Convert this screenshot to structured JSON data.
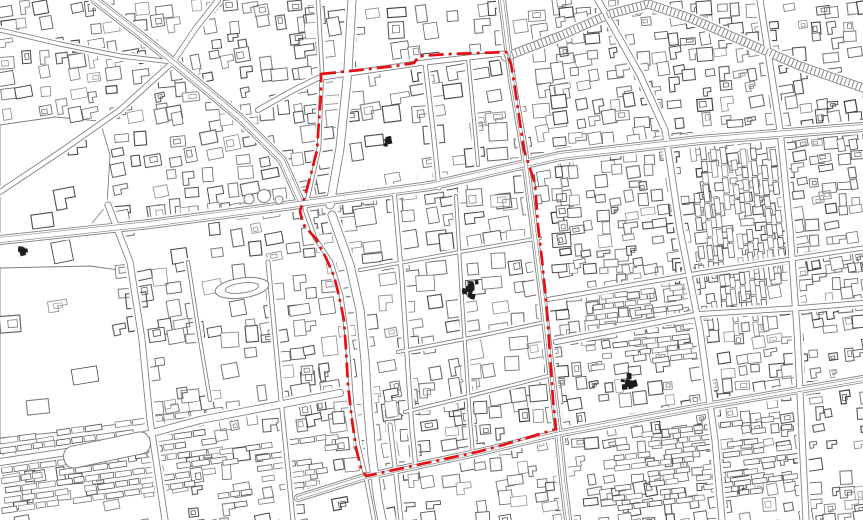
{
  "meta": {
    "canvas": {
      "width": 863,
      "height": 520
    },
    "seed": 1337,
    "colors": {
      "background": "#ffffff",
      "map_line": "#7d7d7d",
      "building_gray_min": 58,
      "building_gray_max": 150,
      "boundary_red": "#e60e13",
      "blob_dark": "#1d1d1d"
    }
  },
  "boundary": {
    "description": "red dash-dot district boundary",
    "stroke_width": 2.7,
    "dash": [
      15,
      5,
      3,
      5
    ],
    "closed": true,
    "points": [
      [
        321,
        74
      ],
      [
        360,
        70
      ],
      [
        395,
        66
      ],
      [
        414,
        63
      ],
      [
        419,
        56
      ],
      [
        450,
        54
      ],
      [
        480,
        53
      ],
      [
        506,
        52
      ],
      [
        511,
        64
      ],
      [
        514,
        82
      ],
      [
        524,
        150
      ],
      [
        535,
        184
      ],
      [
        538,
        226
      ],
      [
        542,
        260
      ],
      [
        546,
        300
      ],
      [
        549,
        340
      ],
      [
        553,
        400
      ],
      [
        556,
        429
      ],
      [
        533,
        436
      ],
      [
        503,
        445
      ],
      [
        477,
        452
      ],
      [
        440,
        460
      ],
      [
        403,
        468
      ],
      [
        366,
        476
      ],
      [
        361,
        468
      ],
      [
        356,
        448
      ],
      [
        352,
        420
      ],
      [
        348,
        385
      ],
      [
        346,
        350
      ],
      [
        344,
        320
      ],
      [
        339,
        296
      ],
      [
        334,
        276
      ],
      [
        326,
        258
      ],
      [
        316,
        239
      ],
      [
        303,
        224
      ],
      [
        300,
        211
      ],
      [
        305,
        196
      ],
      [
        312,
        170
      ],
      [
        317,
        150
      ],
      [
        319,
        120
      ],
      [
        321,
        95
      ]
    ]
  },
  "creek": {
    "width": 4.5,
    "points": [
      [
        318,
        0
      ],
      [
        322,
        70
      ],
      [
        319,
        148
      ],
      [
        305,
        210
      ],
      [
        315,
        238
      ],
      [
        331,
        262
      ],
      [
        341,
        295
      ],
      [
        346,
        330
      ],
      [
        349,
        365
      ],
      [
        352,
        405
      ],
      [
        358,
        445
      ],
      [
        366,
        478
      ],
      [
        374,
        520
      ]
    ]
  },
  "roads": [
    {
      "name": "nw-diagonal-avenue",
      "w": 9,
      "lanes": true,
      "pts": [
        [
          95,
          0
        ],
        [
          140,
          35
        ],
        [
          173,
          62
        ],
        [
          240,
          118
        ],
        [
          282,
          160
        ],
        [
          302,
          205
        ]
      ]
    },
    {
      "name": "ne-sw-cross-street",
      "w": 6,
      "pts": [
        [
          218,
          0
        ],
        [
          196,
          28
        ],
        [
          173,
          62
        ],
        [
          120,
          110
        ],
        [
          60,
          152
        ],
        [
          0,
          192
        ]
      ]
    },
    {
      "name": "west-feeder-street",
      "w": 5,
      "pts": [
        [
          0,
          30
        ],
        [
          60,
          44
        ],
        [
          120,
          56
        ],
        [
          173,
          62
        ]
      ]
    },
    {
      "name": "main-horizontal-boulevard",
      "w": 10,
      "lanes": true,
      "pts": [
        [
          0,
          240
        ],
        [
          150,
          224
        ],
        [
          270,
          208
        ],
        [
          430,
          186
        ],
        [
          560,
          156
        ],
        [
          700,
          140
        ],
        [
          863,
          127
        ]
      ]
    },
    {
      "name": "top-boundary-street",
      "w": 6,
      "pts": [
        [
          258,
          110
        ],
        [
          290,
          92
        ],
        [
          318,
          78
        ],
        [
          420,
          63
        ],
        [
          508,
          53
        ]
      ]
    },
    {
      "name": "elevated-viaduct",
      "w": 9,
      "hatch": true,
      "hatchStep": 4,
      "pts": [
        [
          505,
          57
        ],
        [
          560,
          36
        ],
        [
          610,
          14
        ],
        [
          648,
          4
        ],
        [
          690,
          18
        ],
        [
          745,
          42
        ],
        [
          800,
          66
        ],
        [
          863,
          88
        ]
      ]
    },
    {
      "name": "right-boundary-road",
      "w": 8,
      "lanes": true,
      "pts": [
        [
          502,
          0
        ],
        [
          512,
          80
        ],
        [
          524,
          150
        ],
        [
          543,
          300
        ],
        [
          552,
          380
        ],
        [
          558,
          430
        ],
        [
          563,
          480
        ],
        [
          568,
          520
        ]
      ]
    },
    {
      "name": "east-vertical-street-1",
      "w": 7,
      "pts": [
        [
          598,
          0
        ],
        [
          640,
          75
        ],
        [
          665,
          130
        ],
        [
          680,
          230
        ],
        [
          700,
          330
        ],
        [
          715,
          440
        ],
        [
          722,
          520
        ]
      ]
    },
    {
      "name": "east-vertical-street-2",
      "w": 7,
      "pts": [
        [
          760,
          0
        ],
        [
          780,
          130
        ],
        [
          790,
          230
        ],
        [
          797,
          330
        ],
        [
          806,
          520
        ]
      ]
    },
    {
      "name": "east-cross-street-upper",
      "w": 5,
      "pts": [
        [
          545,
          300
        ],
        [
          700,
          273
        ],
        [
          863,
          248
        ]
      ]
    },
    {
      "name": "east-cross-street-lower",
      "w": 6,
      "pts": [
        [
          556,
          342
        ],
        [
          700,
          314
        ],
        [
          800,
          308
        ],
        [
          863,
          303
        ]
      ]
    },
    {
      "name": "bottom-boundary-road",
      "w": 8,
      "lanes": true,
      "pts": [
        [
          298,
          498
        ],
        [
          365,
          477
        ],
        [
          480,
          452
        ],
        [
          556,
          434
        ],
        [
          700,
          407
        ],
        [
          863,
          379
        ]
      ]
    },
    {
      "name": "southwest-road",
      "w": 8,
      "pts": [
        [
          0,
          462
        ],
        [
          100,
          447
        ],
        [
          200,
          420
        ],
        [
          340,
          393
        ]
      ]
    },
    {
      "name": "west-vertical-street",
      "w": 7,
      "pts": [
        [
          108,
          205
        ],
        [
          130,
          262
        ],
        [
          142,
          340
        ],
        [
          150,
          420
        ],
        [
          165,
          520
        ]
      ]
    },
    {
      "name": "creek-bank-road-north",
      "w": 9,
      "pts": [
        [
          352,
          0
        ],
        [
          348,
          70
        ],
        [
          340,
          148
        ],
        [
          330,
          205
        ]
      ]
    },
    {
      "name": "creek-bank-road-south",
      "w": 9,
      "pts": [
        [
          332,
          215
        ],
        [
          350,
          265
        ],
        [
          360,
          310
        ],
        [
          365,
          360
        ],
        [
          368,
          410
        ],
        [
          372,
          455
        ],
        [
          378,
          500
        ],
        [
          382,
          520
        ]
      ]
    },
    {
      "name": "inner-lane-a",
      "w": 5,
      "pts": [
        [
          425,
          63
        ],
        [
          433,
          130
        ],
        [
          439,
          188
        ]
      ]
    },
    {
      "name": "inner-lane-b",
      "w": 4,
      "pts": [
        [
          468,
          58
        ],
        [
          474,
          120
        ],
        [
          478,
          165
        ]
      ]
    },
    {
      "name": "inner-vertical-1",
      "w": 5,
      "pts": [
        [
          394,
          190
        ],
        [
          402,
          280
        ],
        [
          412,
          430
        ],
        [
          416,
          468
        ]
      ]
    },
    {
      "name": "inner-vertical-2",
      "w": 4,
      "pts": [
        [
          456,
          196
        ],
        [
          462,
          300
        ],
        [
          470,
          420
        ],
        [
          473,
          455
        ]
      ]
    },
    {
      "name": "inner-horizontal-1",
      "w": 4,
      "pts": [
        [
          360,
          270
        ],
        [
          460,
          252
        ],
        [
          540,
          238
        ]
      ]
    },
    {
      "name": "inner-horizontal-2",
      "w": 4,
      "pts": [
        [
          398,
          352
        ],
        [
          470,
          338
        ],
        [
          545,
          322
        ]
      ]
    },
    {
      "name": "inner-horizontal-3",
      "w": 4,
      "pts": [
        [
          405,
          412
        ],
        [
          470,
          396
        ],
        [
          548,
          376
        ]
      ]
    },
    {
      "name": "south-short-street",
      "w": 5,
      "pts": [
        [
          390,
          425
        ],
        [
          396,
          475
        ],
        [
          401,
          520
        ]
      ]
    },
    {
      "name": "left-bottom-vertical",
      "w": 5,
      "pts": [
        [
          268,
          262
        ],
        [
          280,
          390
        ],
        [
          293,
          520
        ]
      ]
    },
    {
      "name": "left-mid-vertical",
      "w": 4,
      "pts": [
        [
          188,
          262
        ],
        [
          200,
          340
        ],
        [
          210,
          400
        ]
      ]
    }
  ],
  "districts": [
    {
      "x": 0,
      "y": 0,
      "w": 310,
      "h": 118,
      "cell": 17,
      "density": 0.72,
      "angle": -8
    },
    {
      "x": 112,
      "y": 112,
      "w": 200,
      "h": 100,
      "cell": 18,
      "density": 0.7,
      "angle": -8
    },
    {
      "x": 112,
      "y": 205,
      "w": 200,
      "h": 132,
      "cell": 19,
      "density": 0.62,
      "angle": -8
    },
    {
      "x": 150,
      "y": 330,
      "w": 165,
      "h": 75,
      "cell": 18,
      "density": 0.6,
      "angle": -8
    },
    {
      "x": 300,
      "y": 0,
      "w": 265,
      "h": 195,
      "cell": 21,
      "density": 0.78,
      "angle": -7
    },
    {
      "x": 295,
      "y": 190,
      "w": 265,
      "h": 225,
      "cell": 21,
      "density": 0.72,
      "angle": -7
    },
    {
      "x": 555,
      "y": 0,
      "w": 308,
      "h": 140,
      "cell": 16,
      "density": 0.82,
      "angle": -7
    },
    {
      "x": 555,
      "y": 135,
      "w": 308,
      "h": 128,
      "cell": 14,
      "density": 0.85,
      "angle": -7
    },
    {
      "x": 555,
      "y": 258,
      "w": 308,
      "h": 262,
      "cell": 15,
      "density": 0.8,
      "angle": -7
    },
    {
      "x": 330,
      "y": 385,
      "w": 232,
      "h": 135,
      "cell": 18,
      "density": 0.72,
      "angle": -7
    },
    {
      "x": 0,
      "y": 262,
      "w": 148,
      "h": 172,
      "cell": 26,
      "density": 0.1,
      "angle": -8
    },
    {
      "x": 0,
      "y": 115,
      "w": 112,
      "h": 132,
      "cell": 24,
      "density": 0.06,
      "angle": -8
    },
    {
      "x": 150,
      "y": 398,
      "w": 180,
      "h": 42,
      "cell": 16,
      "density": 0.5,
      "angle": -8
    },
    {
      "x": 0,
      "y": 432,
      "w": 335,
      "h": 88,
      "cell": 17,
      "density": 0.35,
      "angle": -8
    }
  ],
  "row_districts": [
    {
      "x": 0,
      "y": 440,
      "w": 215,
      "h": 78,
      "dir": "h",
      "rowH": 10,
      "bw": 13,
      "bh": 5.5,
      "density": 0.85,
      "angle": -8
    },
    {
      "x": 215,
      "y": 452,
      "w": 115,
      "h": 62,
      "dir": "h",
      "rowH": 11,
      "bw": 12,
      "bh": 5,
      "density": 0.6,
      "angle": -8
    },
    {
      "x": 693,
      "y": 142,
      "w": 82,
      "h": 112,
      "dir": "v",
      "colW": 10,
      "bw": 5.5,
      "bh": 13,
      "density": 0.8,
      "angle": -7
    },
    {
      "x": 700,
      "y": 245,
      "w": 80,
      "h": 85,
      "dir": "v",
      "colW": 10,
      "bw": 5,
      "bh": 12,
      "density": 0.75,
      "angle": -7
    },
    {
      "x": 586,
      "y": 298,
      "w": 108,
      "h": 80,
      "dir": "h",
      "rowH": 10,
      "bw": 12,
      "bh": 5,
      "density": 0.75,
      "angle": -7
    },
    {
      "x": 612,
      "y": 438,
      "w": 180,
      "h": 76,
      "dir": "h",
      "rowH": 10,
      "bw": 12,
      "bh": 5,
      "density": 0.7,
      "angle": -7
    }
  ],
  "open_areas": [
    {
      "name": "north-field",
      "points": [
        [
          0,
          125
        ],
        [
          55,
          117
        ],
        [
          100,
          121
        ],
        [
          110,
          155
        ],
        [
          107,
          205
        ],
        [
          88,
          228
        ],
        [
          40,
          238
        ],
        [
          0,
          242
        ]
      ]
    },
    {
      "name": "southwest-campus",
      "points": [
        [
          0,
          268
        ],
        [
          90,
          266
        ],
        [
          133,
          272
        ],
        [
          138,
          300
        ],
        [
          142,
          360
        ],
        [
          148,
          420
        ],
        [
          60,
          432
        ],
        [
          0,
          438
        ]
      ]
    }
  ],
  "landmarks": {
    "oval_track": {
      "cx": 242,
      "cy": 288,
      "rx": 27,
      "ry": 10,
      "rx2": 17,
      "ry2": 5,
      "angle": -8
    },
    "long_building": {
      "cx": 107,
      "cy": 450,
      "w": 88,
      "h": 22,
      "angle": -12,
      "r": 10
    },
    "roundabout_circles": [
      [
        249,
        199,
        5
      ],
      [
        264,
        196,
        6.5
      ],
      [
        279,
        200,
        4
      ]
    ],
    "dark_blobs": [
      [
        470,
        288,
        9,
        14
      ],
      [
        629,
        384,
        8,
        11
      ],
      [
        388,
        142,
        4,
        5
      ],
      [
        23,
        249,
        4,
        5
      ]
    ]
  }
}
